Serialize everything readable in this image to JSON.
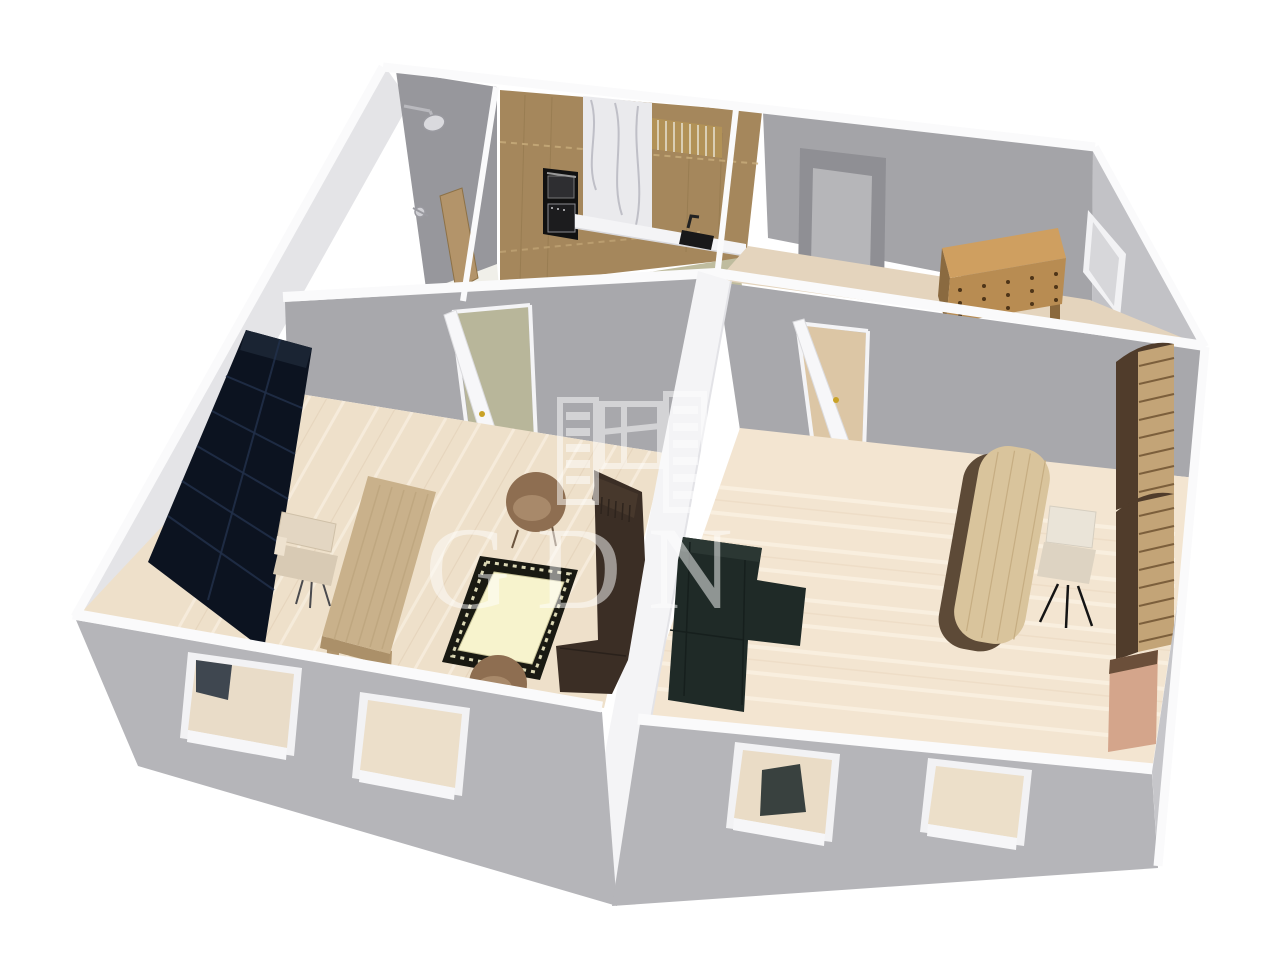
{
  "scene": {
    "type": "3d-floor-plan-render",
    "background": "#ffffff",
    "description": "Isometric 3D rendering of a four-room apartment floor plan seen from above"
  },
  "watermark": {
    "text": "GDN",
    "opacity": 0.5
  },
  "colors": {
    "wall_top": "#fafafb",
    "wall_face_left": "#e4e4e7",
    "wall_face_bath_back": "#97979c",
    "wall_face_inner": "#a8a8ac",
    "wall_face_topright": "#a4a4a8",
    "wall_face_right_upper": "#c2c2c6",
    "wall_face_right_lower": "#c6c6ca",
    "wall_outer_front": "#b5b5b9",
    "wall_divider_white": "#f4f4f6",
    "floor_living": "#eee0ca",
    "floor_kitchen": "#bfbc9e",
    "floor_topright": "#e4d4bd",
    "floor_bottomright": "#f3e5d1",
    "floor_bathroom": "#f0efe9",
    "bookcase": "#0c1320",
    "desk_wood": "#c9b18b",
    "chair_cream": "#e3d6c2",
    "armchair_brown": "#8e6e51",
    "armchair_seat": "#a8896a",
    "rug_field": "#f7f3cd",
    "rug_border": "#191912",
    "sofa_brown": "#3b2e25",
    "sofa_sectional": "#1f2a27",
    "desk_round_top": "#d9c49c",
    "desk_round_base": "#5d4a37",
    "shelf_wood": "#c3a477",
    "shelf_frame": "#503c2b",
    "wardrobe_pink": "#d4a58b",
    "dresser_top": "#cf9f60",
    "dresser_front": "#b88c52",
    "cabinet_wood": "#a5875c",
    "marble": "#eaeaed",
    "countertop": "#f4f4f6",
    "appliance_black": "#111111",
    "sink_black": "#18181a",
    "door_white": "#f7f7f9",
    "door_wood": "#b3946a",
    "door_gray_frame": "#8f8f94",
    "door_gray_panel": "#b6b6b9",
    "handle_gold": "#c9a227",
    "glass": "#d7d7da",
    "window_frame": "#f2f2f4"
  },
  "rooms": [
    {
      "id": "room-top-left",
      "position": "top-left",
      "furniture": [
        "shower head",
        "shower mixer valve",
        "wooden door"
      ]
    },
    {
      "id": "kitchen",
      "position": "top-center",
      "furniture": [
        "upper cabinets",
        "lower cabinets",
        "marble backsplash",
        "built-in oven",
        "countertop",
        "sink",
        "dish rack"
      ]
    },
    {
      "id": "room-top-right",
      "position": "top-right",
      "furniture": [
        "gray interior door",
        "chest of drawers",
        "side window"
      ]
    },
    {
      "id": "room-bottom-left",
      "position": "bottom-left",
      "furniture": [
        "dark bookcase",
        "wooden desk",
        "office chair",
        "armchair",
        "armchair",
        "bordered rug",
        "brown sofa",
        "open interior door",
        "front window",
        "front window"
      ]
    },
    {
      "id": "room-bottom-right",
      "position": "bottom-right",
      "furniture": [
        "dark corner sofa",
        "oval desk",
        "swivel chair",
        "shelving unit",
        "shelving unit",
        "wardrobe",
        "open interior door",
        "front window",
        "front window"
      ]
    }
  ]
}
